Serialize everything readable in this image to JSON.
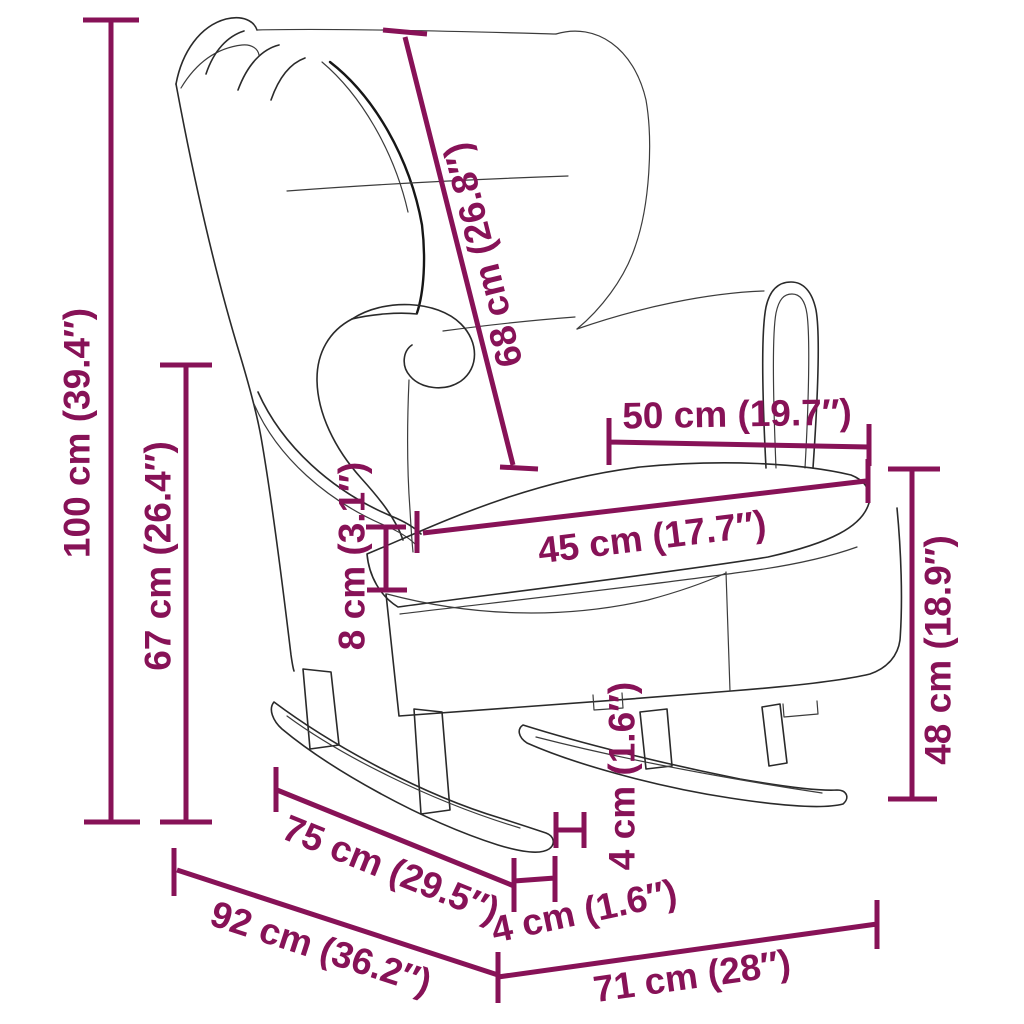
{
  "diagram": {
    "subject": "wingback rocking chair dimension drawing",
    "colors": {
      "dimension_accent": "#871257",
      "outline": "#2a2a2a",
      "background": "#ffffff"
    },
    "units": {
      "metric": "cm",
      "imperial": "in"
    }
  },
  "dims": {
    "total_height": {
      "label": "100 cm (39.4″)",
      "cm": 100,
      "inch": 39.4
    },
    "back_height": {
      "label": "67 cm (26.4″)",
      "cm": 67,
      "inch": 26.4
    },
    "backrest": {
      "label": "68 cm (26.8″)",
      "cm": 68,
      "inch": 26.8
    },
    "seat_depth_top": {
      "label": "50 cm (19.7″)",
      "cm": 50,
      "inch": 19.7
    },
    "seat_width": {
      "label": "45 cm (17.7″)",
      "cm": 45,
      "inch": 17.7
    },
    "cushion": {
      "label": "8 cm (3.1″)",
      "cm": 8,
      "inch": 3.1
    },
    "seat_height": {
      "label": "48 cm (18.9″)",
      "cm": 48,
      "inch": 18.9
    },
    "gap_side": {
      "label": "4 cm (1.6″)",
      "cm": 4,
      "inch": 1.6
    },
    "gap_front": {
      "label": "4 cm (1.6″)",
      "cm": 4,
      "inch": 1.6
    },
    "rocker": {
      "label": "75 cm (29.5″)",
      "cm": 75,
      "inch": 29.5
    },
    "depth": {
      "label": "92 cm (36.2″)",
      "cm": 92,
      "inch": 36.2
    },
    "width": {
      "label": "71 cm (28″)",
      "cm": 71,
      "inch": 28
    }
  }
}
